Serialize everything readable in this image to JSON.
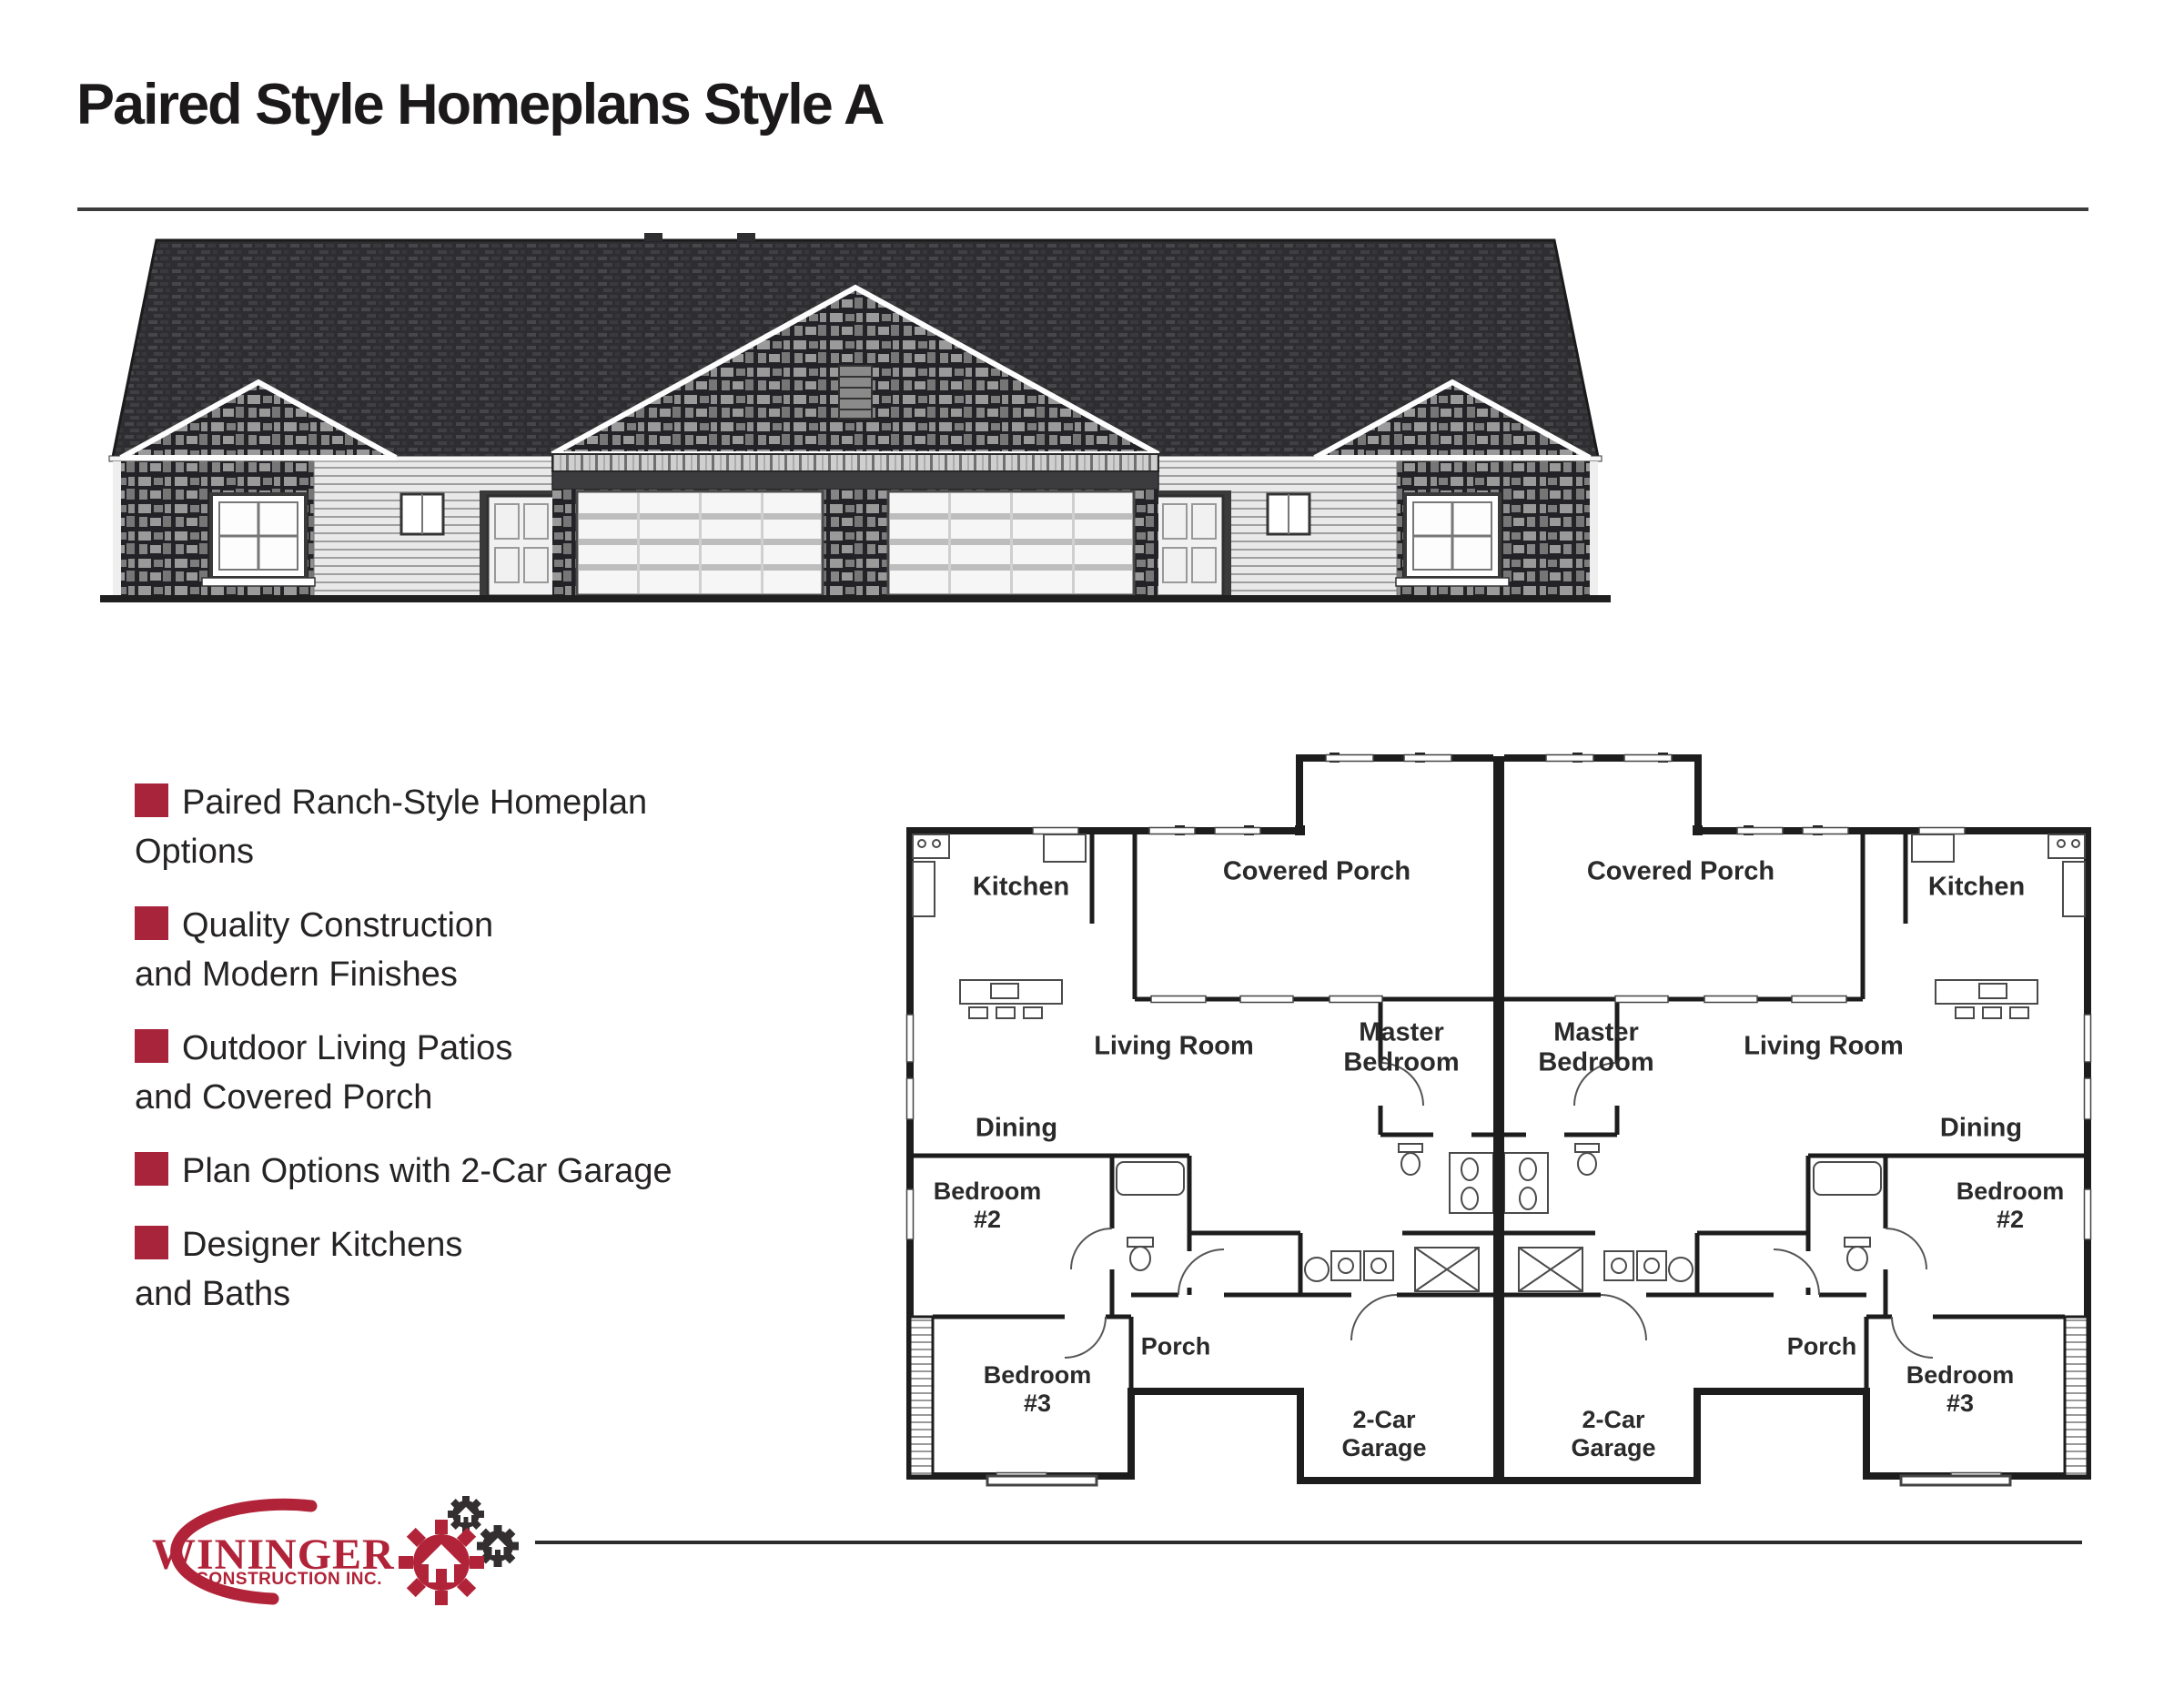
{
  "page": {
    "title": "Paired Style Homeplans Style A"
  },
  "features": {
    "items": [
      "Paired Ranch-Style Homeplan\nOptions",
      "Quality Construction\nand Modern Finishes",
      "Outdoor Living Patios\nand Covered Porch",
      "Plan Options with 2-Car Garage",
      "Designer Kitchens\nand Baths"
    ]
  },
  "floor_plan": {
    "labels": {
      "kitchen": "Kitchen",
      "covered_porch": "Covered Porch",
      "living_room": "Living Room",
      "master_bedroom": "Master\nBedroom",
      "dining": "Dining",
      "bedroom_2": "Bedroom\n#2",
      "bedroom_3": "Bedroom\n#3",
      "porch": "Porch",
      "garage": "2-Car\nGarage"
    }
  },
  "logo": {
    "company": "WININGER",
    "tagline": "CONSTRUCTION INC."
  },
  "colors": {
    "brand_red": "#b12338",
    "bullet_red": "#a7243b",
    "gear_dark": "#332f31",
    "ink": "#1c191a",
    "plan_wall": "#1d1d1d"
  }
}
